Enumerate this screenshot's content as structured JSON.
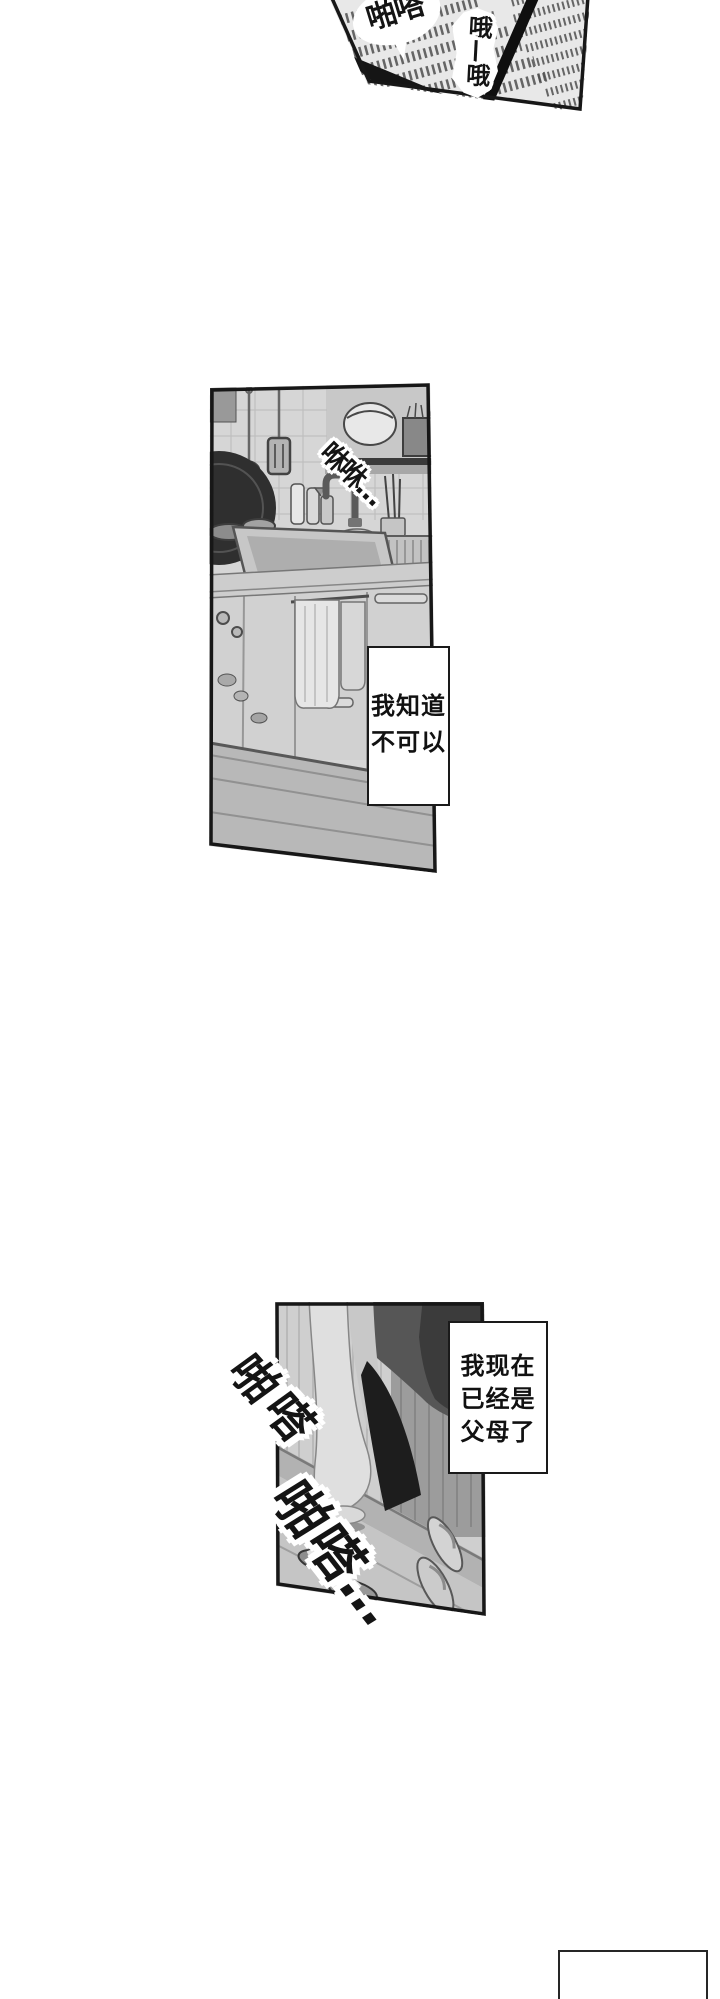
{
  "colors": {
    "page_bg": "#ffffff",
    "ink": "#1a1a1a",
    "panel_light_gray": "#dbdbdb",
    "panel_mid_gray": "#a5a5a5",
    "speech_bg": "#ffffff"
  },
  "panels": {
    "newspaper": {
      "sfx_patter": "啪嗒",
      "sfx_oh": "哦—哦"
    },
    "kitchen": {
      "sfx_water": "咻咻…",
      "speech": {
        "line1": "我知道",
        "line2": "不可以"
      }
    },
    "entryway": {
      "sfx_step_1": "啪嗒",
      "sfx_step_2": "啪嗒…",
      "speech": {
        "line1": "我现在",
        "line2": "已经是",
        "line3": "父母了"
      }
    }
  }
}
